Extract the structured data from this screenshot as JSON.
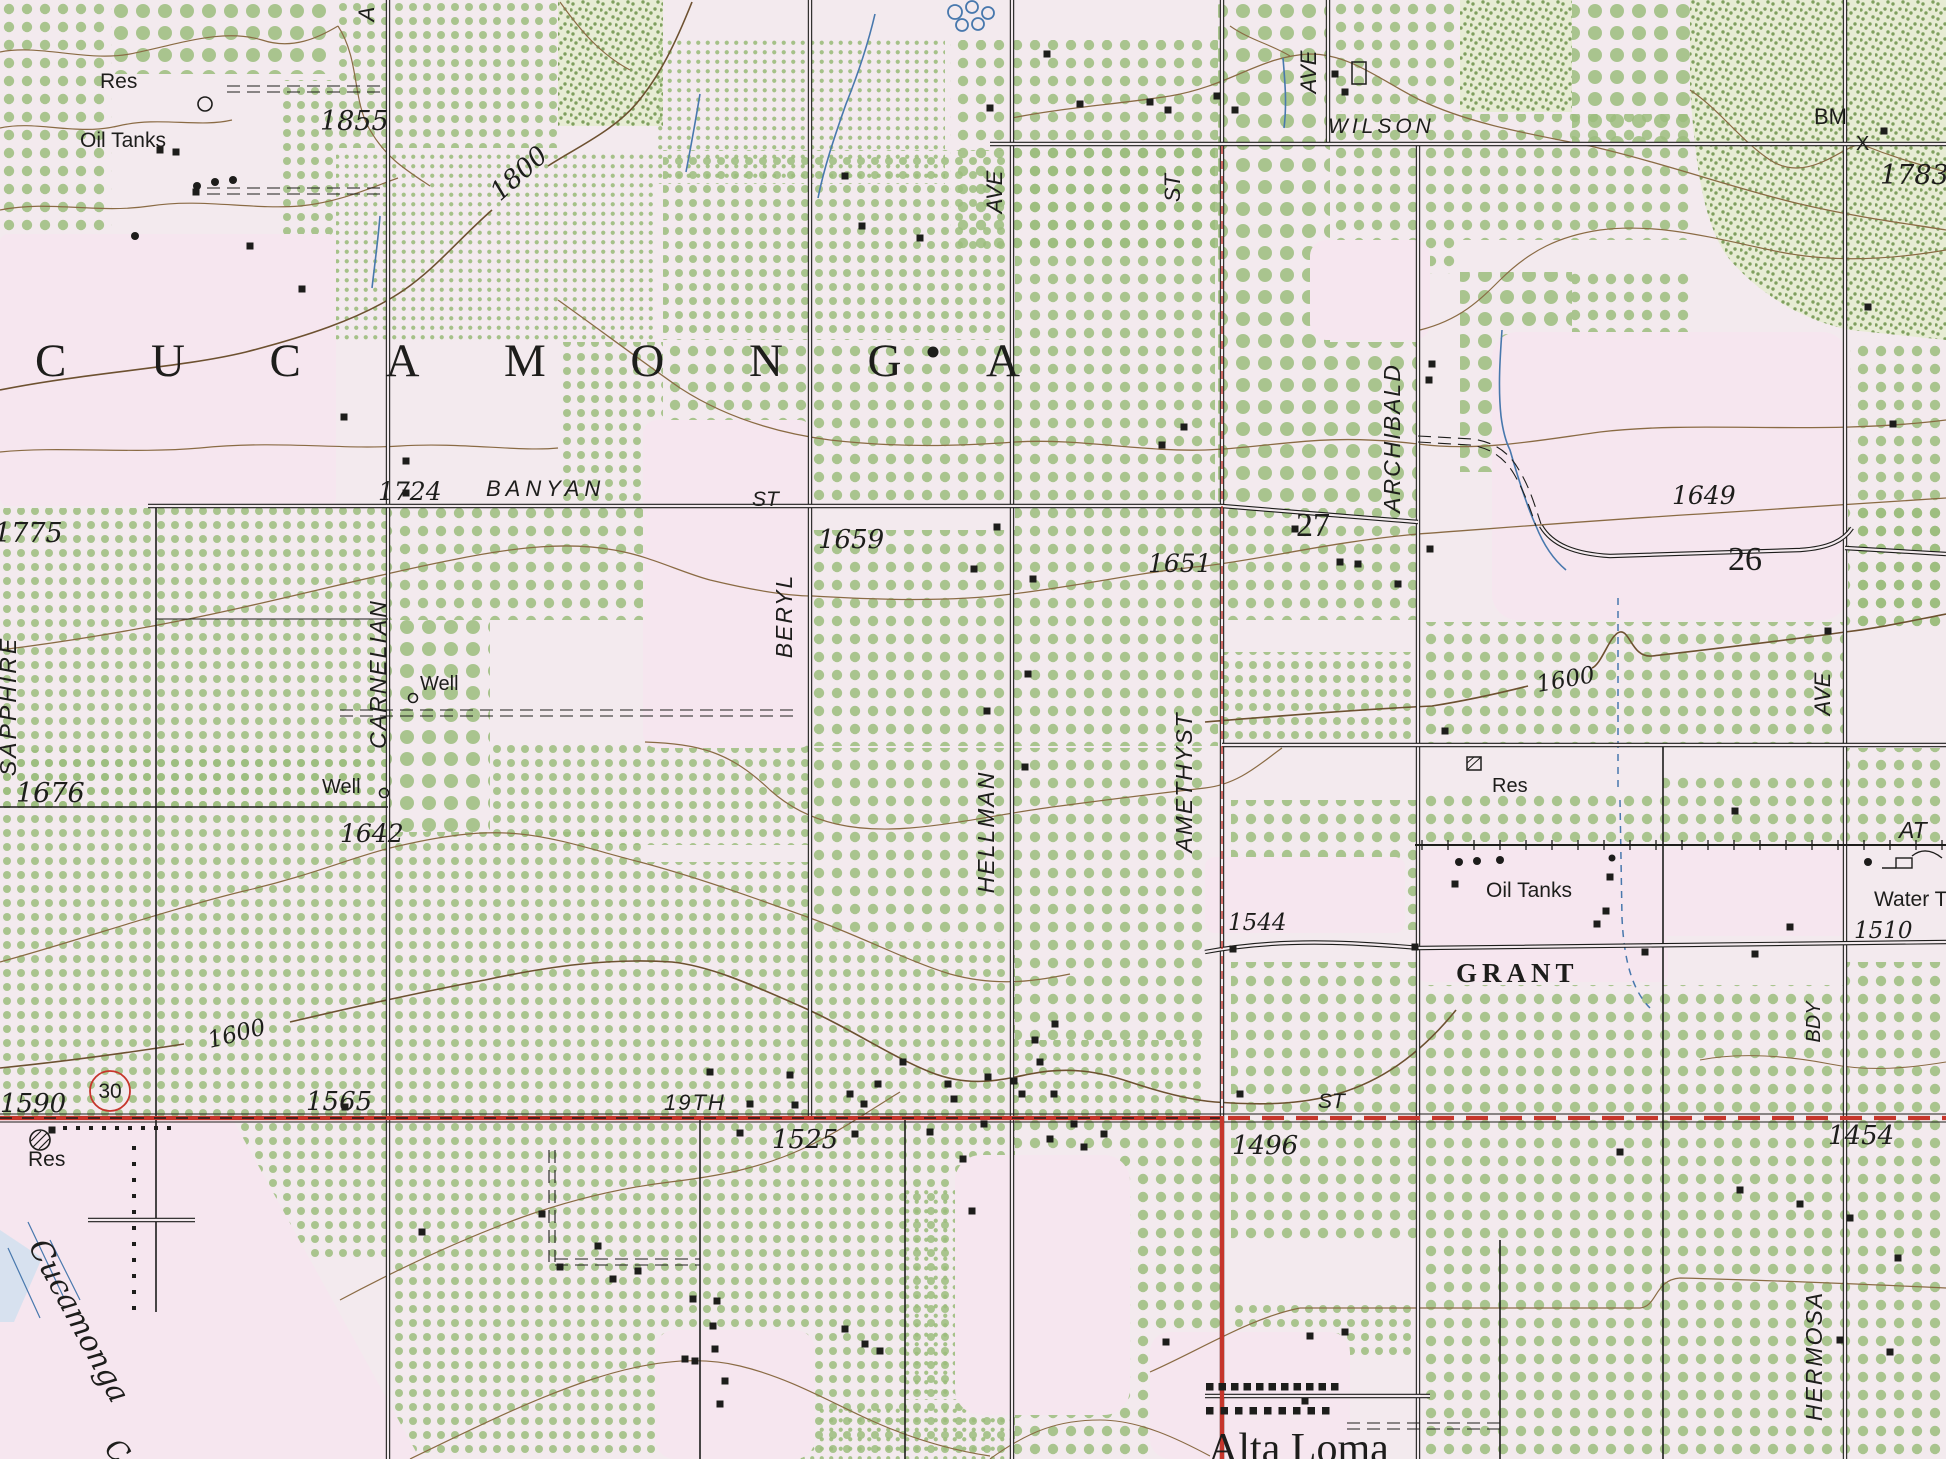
{
  "map": {
    "title": "Cucamonga area topographic map (scanned USGS quadrangle detail)",
    "region_name": "CUCAMONGA",
    "town_name": "Alta Loma"
  },
  "colors": {
    "paper": "#f3eaee",
    "pink": "#f6e6ef",
    "ink": "#1d1d1b",
    "contour": "#8a6b44",
    "contour_dark": "#6d5130",
    "water": "#4878ad",
    "red": "#c6352b",
    "orchard": "#9dbd7e",
    "scrub": "#7fa05e",
    "scrub_bg": "#e7ecd4"
  },
  "labels": {
    "place": [
      {
        "n": "region-name",
        "text": "CUCAMONGA",
        "x": 35,
        "y": 376,
        "s": 47,
        "f": "serif",
        "tl": 985
      },
      {
        "n": "town-alta-loma",
        "text": "Alta Loma",
        "x": 1208,
        "y": 1462,
        "s": 42,
        "f": "serif"
      },
      {
        "n": "creek-cucamonga",
        "text": "Cucamonga",
        "x": 28,
        "y": 1246,
        "s": 30,
        "i": 1,
        "f": "dserif",
        "r": 62
      },
      {
        "n": "creek-c-partial",
        "text": "C",
        "x": 103,
        "y": 1450,
        "s": 28,
        "i": 1,
        "f": "dserif",
        "r": 45
      }
    ],
    "streets": [
      {
        "n": "street-wilson",
        "text": "WILSON",
        "x": 1328,
        "y": 133,
        "s": 21,
        "i": 1,
        "ls": 4
      },
      {
        "n": "street-banyan",
        "text": "BANYAN",
        "x": 486,
        "y": 496,
        "s": 22,
        "i": 1,
        "ls": 5
      },
      {
        "n": "street-banyan-st",
        "text": "ST",
        "x": 752,
        "y": 506,
        "s": 21,
        "i": 1
      },
      {
        "n": "street-19th",
        "text": "19TH",
        "x": 664,
        "y": 1110,
        "s": 22,
        "i": 1,
        "ls": 2
      },
      {
        "n": "street-19th-st",
        "text": "ST",
        "x": 1318,
        "y": 1108,
        "s": 21,
        "i": 1
      },
      {
        "n": "street-grant",
        "text": "GRANT",
        "x": 1456,
        "y": 982,
        "s": 27,
        "f": "serif",
        "ls": 5,
        "w": "bold"
      },
      {
        "n": "street-sapphire",
        "text": "SAPPHIRE",
        "x": 16,
        "y": 706,
        "s": 23,
        "i": 1,
        "ls": 3,
        "r": -90,
        "a": "middle"
      },
      {
        "n": "street-carnelian",
        "text": "CARNELIAN",
        "x": 386,
        "y": 674,
        "s": 23,
        "i": 1,
        "ls": 2,
        "r": -90,
        "a": "middle"
      },
      {
        "n": "street-beryl",
        "text": "BERYL",
        "x": 792,
        "y": 616,
        "s": 23,
        "i": 1,
        "ls": 2,
        "r": -90,
        "a": "middle"
      },
      {
        "n": "street-hellman",
        "text": "HELLMAN",
        "x": 994,
        "y": 832,
        "s": 23,
        "i": 1,
        "ls": 2,
        "r": -90,
        "a": "middle"
      },
      {
        "n": "street-amethyst",
        "text": "AMETHYST",
        "x": 1192,
        "y": 782,
        "s": 23,
        "i": 1,
        "ls": 2,
        "r": -90,
        "a": "middle"
      },
      {
        "n": "street-archibald",
        "text": "ARCHIBALD",
        "x": 1400,
        "y": 438,
        "s": 23,
        "i": 1,
        "ls": 2,
        "r": -90,
        "a": "middle"
      },
      {
        "n": "street-hermosa",
        "text": "HERMOSA",
        "x": 1822,
        "y": 1356,
        "s": 23,
        "i": 1,
        "ls": 2,
        "r": -90,
        "a": "middle"
      },
      {
        "n": "street-hellman-ave",
        "text": "AVE",
        "x": 1002,
        "y": 192,
        "s": 22,
        "i": 1,
        "r": -90,
        "a": "middle"
      },
      {
        "n": "street-amethyst-st",
        "text": "ST",
        "x": 1180,
        "y": 188,
        "s": 22,
        "i": 1,
        "r": -90,
        "a": "middle"
      },
      {
        "n": "street-archibald-ave",
        "text": "AVE",
        "x": 1316,
        "y": 72,
        "s": 22,
        "i": 1,
        "r": -90,
        "a": "middle"
      },
      {
        "n": "street-hermosa-ave",
        "text": "AVE",
        "x": 1830,
        "y": 694,
        "s": 22,
        "i": 1,
        "r": -90,
        "a": "middle"
      },
      {
        "n": "street-bdy",
        "text": "BDY",
        "x": 1820,
        "y": 1022,
        "s": 20,
        "i": 1,
        "r": -90,
        "a": "middle"
      },
      {
        "n": "street-cut-letter",
        "text": "A",
        "x": 374,
        "y": 14,
        "s": 22,
        "i": 1,
        "r": -90,
        "a": "middle"
      },
      {
        "n": "railroad-at",
        "text": "AT",
        "x": 1899,
        "y": 838,
        "s": 23,
        "i": 1
      }
    ],
    "features": [
      {
        "n": "feature-res-nw",
        "text": "Res",
        "x": 100,
        "y": 88,
        "s": 21
      },
      {
        "n": "feature-oil-tanks-nw",
        "text": "Oil Tanks",
        "x": 80,
        "y": 147,
        "s": 21
      },
      {
        "n": "feature-well-1",
        "text": "Well",
        "x": 420,
        "y": 690,
        "s": 20
      },
      {
        "n": "feature-well-2",
        "text": "Well",
        "x": 322,
        "y": 793,
        "s": 20
      },
      {
        "n": "feature-res-e",
        "text": "Res",
        "x": 1492,
        "y": 792,
        "s": 20
      },
      {
        "n": "feature-oil-tanks-e",
        "text": "Oil Tanks",
        "x": 1486,
        "y": 897,
        "s": 21
      },
      {
        "n": "feature-water-tank",
        "text": "Water T",
        "x": 1874,
        "y": 906,
        "s": 21
      },
      {
        "n": "feature-res-sw",
        "text": "Res",
        "x": 28,
        "y": 1166,
        "s": 21
      },
      {
        "n": "feature-bm",
        "text": "BM",
        "x": 1814,
        "y": 124,
        "s": 22
      },
      {
        "n": "feature-bm-x",
        "text": "X",
        "x": 1856,
        "y": 150,
        "s": 20
      }
    ],
    "elevations": [
      {
        "n": "elev-1855",
        "text": "1855",
        "x": 320,
        "y": 130,
        "s": 27
      },
      {
        "n": "elev-1783",
        "text": "1783",
        "x": 1880,
        "y": 184,
        "s": 27
      },
      {
        "n": "elev-1775",
        "text": "1775",
        "x": -6,
        "y": 542,
        "s": 27
      },
      {
        "n": "elev-1724",
        "text": "1724",
        "x": 378,
        "y": 500,
        "s": 25
      },
      {
        "n": "elev-1659",
        "text": "1659",
        "x": 818,
        "y": 548,
        "s": 26
      },
      {
        "n": "elev-1651",
        "text": "1651",
        "x": 1148,
        "y": 572,
        "s": 25
      },
      {
        "n": "elev-1649",
        "text": "1649",
        "x": 1672,
        "y": 504,
        "s": 25
      },
      {
        "n": "elev-1676",
        "text": "1676",
        "x": 16,
        "y": 802,
        "s": 27
      },
      {
        "n": "elev-1642",
        "text": "1642",
        "x": 340,
        "y": 842,
        "s": 25
      },
      {
        "n": "elev-1544",
        "text": "1544",
        "x": 1228,
        "y": 930,
        "s": 23
      },
      {
        "n": "elev-1510",
        "text": "1510",
        "x": 1854,
        "y": 938,
        "s": 23
      },
      {
        "n": "elev-1590",
        "text": "1590",
        "x": 0,
        "y": 1112,
        "s": 26
      },
      {
        "n": "elev-1565",
        "text": "1565",
        "x": 306,
        "y": 1110,
        "s": 26
      },
      {
        "n": "elev-1525",
        "text": "1525",
        "x": 772,
        "y": 1148,
        "s": 26
      },
      {
        "n": "elev-1496",
        "text": "1496",
        "x": 1232,
        "y": 1154,
        "s": 26
      },
      {
        "n": "elev-1454",
        "text": "1454",
        "x": 1828,
        "y": 1144,
        "s": 26
      }
    ],
    "contour_labels": [
      {
        "n": "contour-1800",
        "text": "1800",
        "x": 500,
        "y": 202,
        "s": 26,
        "r": -42,
        "c": "contour_dark"
      },
      {
        "n": "contour-1600-e",
        "text": "1600",
        "x": 1538,
        "y": 692,
        "s": 23,
        "r": -10,
        "c": "contour_dark"
      },
      {
        "n": "contour-1600-w",
        "text": "1600",
        "x": 210,
        "y": 1048,
        "s": 23,
        "r": -14,
        "c": "contour_dark"
      }
    ],
    "route_numbers": [
      {
        "n": "section-27",
        "text": "27",
        "x": 1296,
        "y": 536,
        "s": 34,
        "f": "serif",
        "c": "red"
      },
      {
        "n": "section-26",
        "text": "26",
        "x": 1728,
        "y": 570,
        "s": 34,
        "f": "serif",
        "c": "red"
      },
      {
        "n": "route-30",
        "text": "30",
        "x": 110,
        "y": 1098,
        "s": 21,
        "c": "red",
        "a": "middle"
      }
    ]
  }
}
